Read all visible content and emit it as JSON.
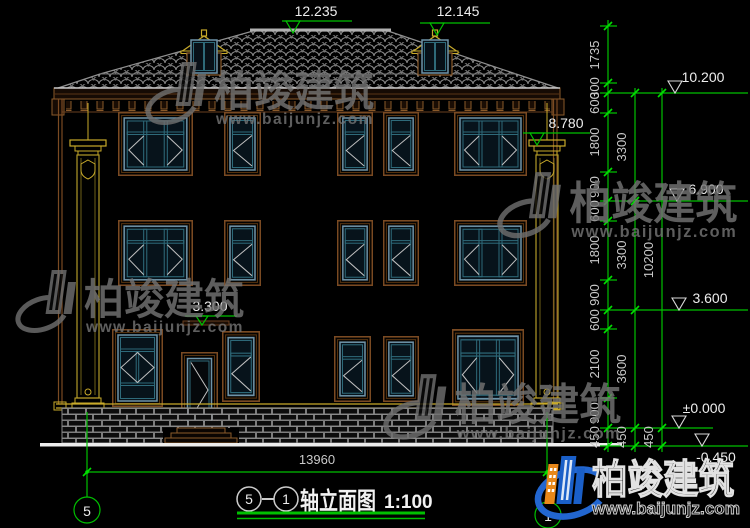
{
  "watermark": {
    "name": "柏竣建筑",
    "url": "www.baijunjz.com"
  },
  "logo": {
    "name": "柏竣建筑",
    "url": "www.baijunjz.com"
  },
  "title": {
    "axis_from": "5",
    "axis_to": "1",
    "name": "轴立面图",
    "scale": "1:100"
  },
  "axes": {
    "left": "5",
    "right": "1"
  },
  "elevation_marks": {
    "ridge": "12.235",
    "dormer": "12.145",
    "eave": "10.200",
    "capital": "8.780",
    "level3": "6.900",
    "level2_right": "3.600",
    "level2_inner": "3.300",
    "ground": "±0.000",
    "site": "-0.450"
  },
  "dimensions": {
    "total_width": "13960",
    "chain_inner": [
      "1735",
      "300",
      "600",
      "1800",
      "900",
      "600",
      "1800",
      "900",
      "600",
      "2100",
      "900",
      "450"
    ],
    "chain_middle": [
      "3300",
      "3300",
      "3600",
      "450"
    ],
    "chain_outer": [
      "10200",
      "450"
    ]
  },
  "colors": {
    "dimension_green": "#00c000",
    "frame_brown": "#7a4a22",
    "window_teal": "#2e6a7a",
    "column_yellow": "#c8aa2a",
    "logo_blue": "#1a5fc8",
    "logo_orange": "#e8881a"
  }
}
